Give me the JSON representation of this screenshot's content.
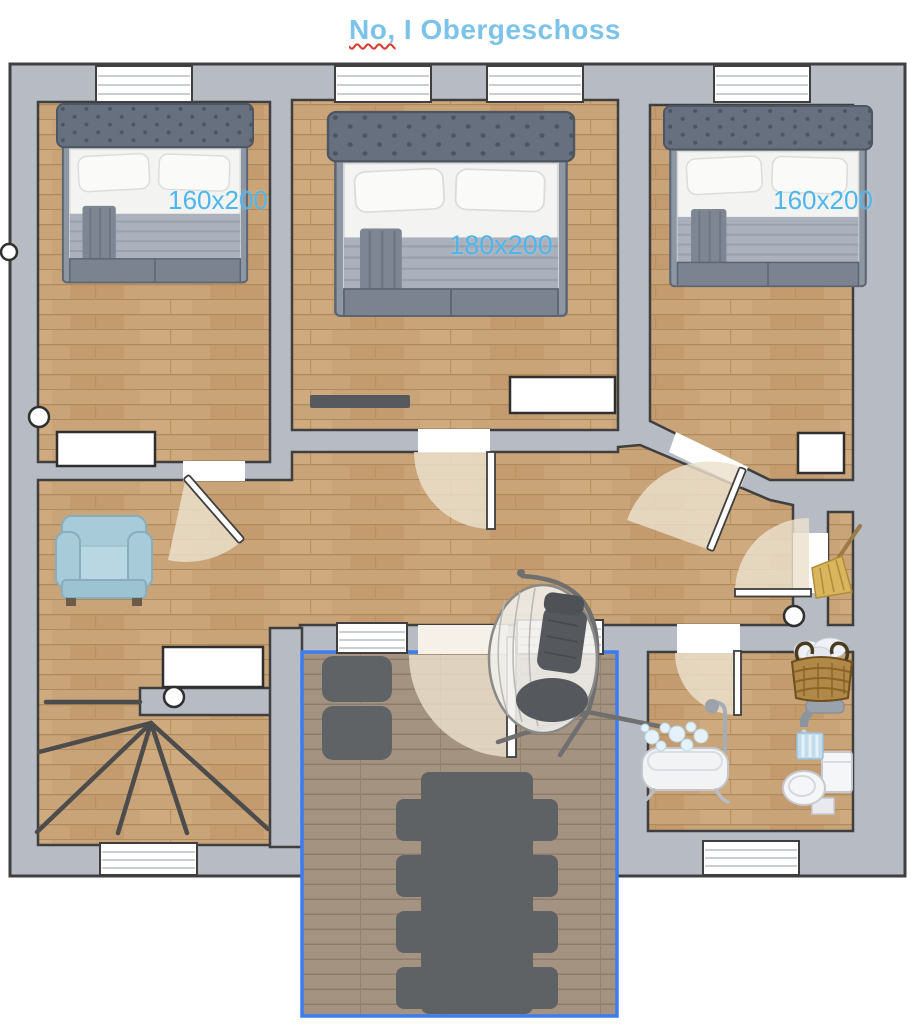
{
  "title": {
    "prefix": "No,",
    "rest": " I Obergeschoss"
  },
  "floor_plan": {
    "floor_name": "Obergeschoss",
    "rooms": [
      {
        "id": "bedroom-left",
        "bed_label": "160x200"
      },
      {
        "id": "bedroom-middle",
        "bed_label": "180x200"
      },
      {
        "id": "bedroom-right",
        "bed_label": "160x200"
      },
      {
        "id": "hallway"
      },
      {
        "id": "staircase-room"
      },
      {
        "id": "bathroom"
      },
      {
        "id": "closet"
      },
      {
        "id": "balcony"
      }
    ],
    "furniture": [
      {
        "name": "double-bed",
        "room": "bedroom-left",
        "size": "160x200"
      },
      {
        "name": "double-bed",
        "room": "bedroom-middle",
        "size": "180x200"
      },
      {
        "name": "double-bed",
        "room": "bedroom-right",
        "size": "160x200"
      },
      {
        "name": "armchair",
        "room": "hallway"
      },
      {
        "name": "hanging-egg-chair",
        "room": "balcony"
      },
      {
        "name": "lounger",
        "room": "balcony"
      },
      {
        "name": "dining-table",
        "room": "balcony",
        "chairs": 8
      },
      {
        "name": "winder-stairs",
        "room": "staircase-room"
      },
      {
        "name": "bathtub",
        "room": "bathroom"
      },
      {
        "name": "faucet",
        "room": "bathroom"
      },
      {
        "name": "water-glass",
        "room": "bathroom"
      },
      {
        "name": "toilet",
        "room": "bathroom"
      },
      {
        "name": "laundry-basket",
        "room": "bathroom"
      },
      {
        "name": "broom",
        "room": "closet"
      }
    ],
    "colors": {
      "wall": "#b7bbc3",
      "outline": "#3f3f3f",
      "wood": "#c9a478",
      "deck": "#a59381",
      "balcony_border": "#3b7cf0",
      "door_swing": "#ece0cd",
      "label_blue": "#4fb6ec",
      "title_blue": "#7cc3ea",
      "furniture_dark": "#5f6265"
    }
  }
}
